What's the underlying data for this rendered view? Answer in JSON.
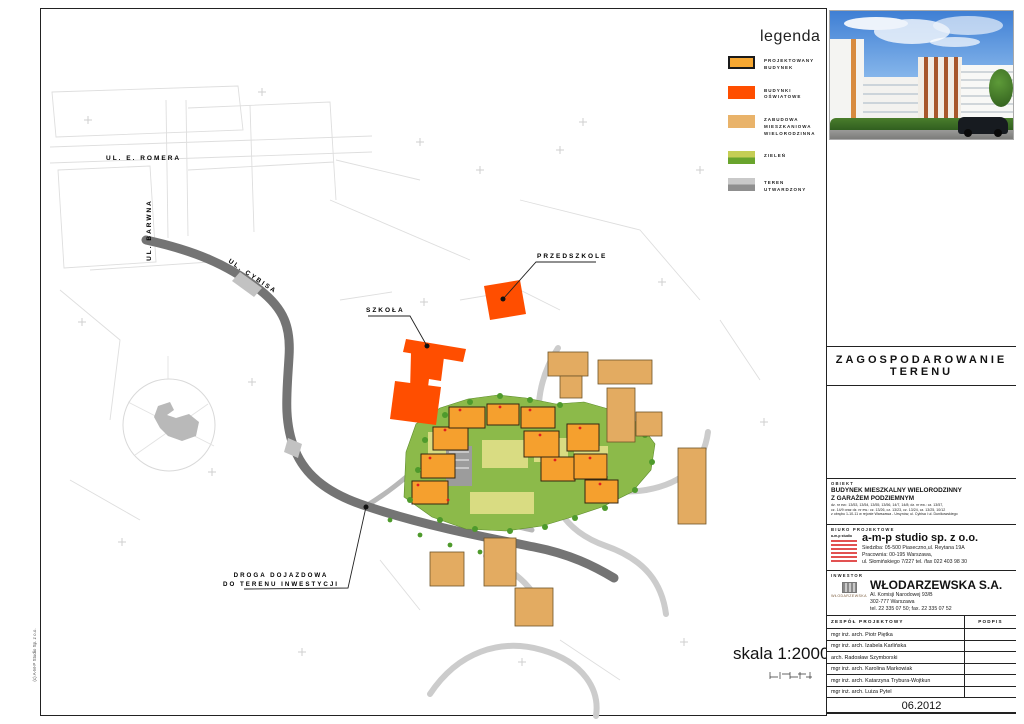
{
  "page": {
    "copyright": "(c) A-M-P Studio Sp. z o.o."
  },
  "legend": {
    "title": "legenda",
    "items": [
      {
        "label": "PROJEKTOWANY BUDYNEK",
        "color": "#F7A832",
        "border": "#1a1a1a"
      },
      {
        "label": "BUDYNKI OŚWIATOWE",
        "color": "#FF4E00"
      },
      {
        "label": "ZABUDOWA MIESZKANIOWA WIELORODZINNA",
        "color": "#E9B36A"
      },
      {
        "label": "ZIELEŃ",
        "color": "#C5CE55",
        "color2": "#69A42D"
      },
      {
        "label": "TEREN UTWARDZONY",
        "color": "#C9C9C9",
        "color2": "#8F8F8F"
      }
    ]
  },
  "map": {
    "labels": {
      "street_romera": "UL. E. ROMERA",
      "street_barwna": "UL. BARWNA",
      "street_cybisa": "UL. CYBISA",
      "school": "SZKOŁA",
      "kindergarten": "PRZEDSZKOLE",
      "access_road_line1": "DROGA DOJAZDOWA",
      "access_road_line2": "DO TERENU INWESTYCJI"
    },
    "scale_text": "skala 1:2000"
  },
  "titleblock": {
    "drawing_title_line1": "ZAGOSPODAROWANIE",
    "drawing_title_line2": "TERENU",
    "obiekt": {
      "label": "OBIEKT",
      "name_line1": "BUDYNEK MIESZKALNY WIELORODZINNY",
      "name_line2": "Z GARAŻEM PODZIEMNYM",
      "details_line1": "dz. nr ew.: 13/53, 13/54, 13/55, 13/56, 14/7, 14/8; dz. nr ew.: cz. 13/57,",
      "details_line2": "cz. 14/9 oraz dz. nr ew.: cz. 13/26, cz. 13/23, cz. 13/24, cz. 13/25, 10/12",
      "details_line3": "z obrębu 1-10-11 w rejonie Warszawa - Ursynów, ul. Cybisa i ul. Dunikowskiego"
    },
    "biuro": {
      "label": "BIURO PROJEKTOWE",
      "logo_text": "a-m-p studio",
      "name": "a-m-p studio sp. z o.o.",
      "line1": "Siedziba: 05-500 Piaseczno,ul. Reytana 19A",
      "line2": "Pracownia: 00-195 Warszawa,",
      "line3": "ul. Słomińskiego 7/227  tel. /fax 022 403 98 30"
    },
    "inwestor": {
      "label": "INWESTOR",
      "logo_text": "WŁODARZEWSKA",
      "name": "WŁODARZEWSKA S.A.",
      "line1": "Al. Komisji Narodowej 93/B",
      "line2": "302-777 Warszawa",
      "line3": "tel. 22 335 07 50; fax. 22 335 07 52"
    },
    "zespol": {
      "label": "ZESPÓŁ PROJEKTOWY",
      "podpis_label": "PODPIS",
      "members": [
        "mgr inż. arch. Piotr Piętka",
        "mgr inż. arch. Izabela Karlińska",
        "arch. Radosław Szymborski",
        "mgr inż. arch. Karolina Markowiak",
        "mgr inż. arch. Katarzyna Trybura-Wojtkun",
        "mgr inż. arch. Luiza Pytel"
      ]
    },
    "date": "06.2012"
  },
  "colors": {
    "projected_building": "#F7A832",
    "education_building": "#FF4E00",
    "existing_housing": "#E9B36A",
    "greenery": "#69A42D",
    "paved_area": "#8F8F8F",
    "main_road": "#747474"
  }
}
